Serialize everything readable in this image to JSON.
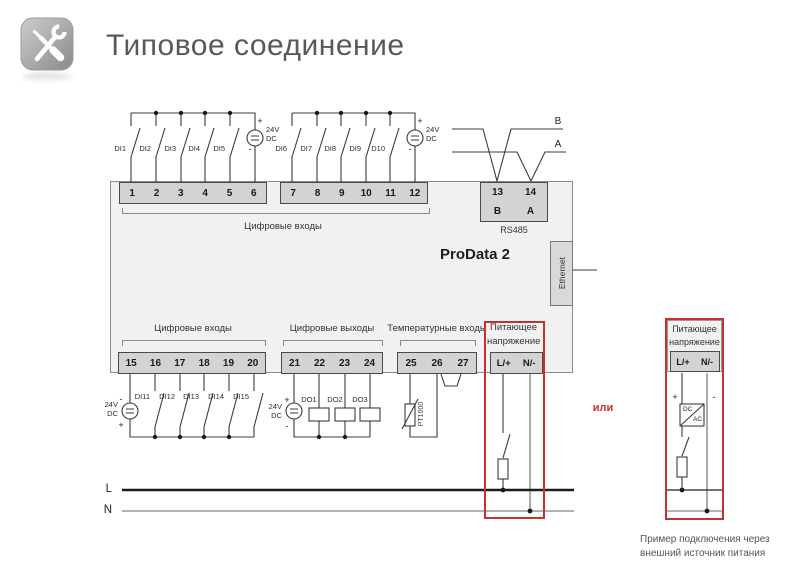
{
  "header": {
    "title": "Типовое соединение"
  },
  "device": {
    "name": "ProData 2",
    "ethernet": "Ethernet",
    "rs485_label": "RS485",
    "top1": [
      "1",
      "2",
      "3",
      "4",
      "5",
      "6"
    ],
    "top2": [
      "7",
      "8",
      "9",
      "10",
      "11",
      "12"
    ],
    "rs485": {
      "n1": "13",
      "n2": "14",
      "b": "B",
      "a": "A"
    },
    "bot1": [
      "15",
      "16",
      "17",
      "18",
      "19",
      "20"
    ],
    "bot2": [
      "21",
      "22",
      "23",
      "24"
    ],
    "bot3": [
      "25",
      "26",
      "27"
    ],
    "pwr": {
      "l": "L/+",
      "n": "N/-"
    }
  },
  "groups": {
    "digital_inputs_top": "Цифровые входы",
    "digital_inputs_bottom": "Цифровые входы",
    "digital_outputs": "Цифровые выходы",
    "temperature_inputs": "Температурные входы",
    "supply1": "Питающее",
    "supply2": "напряжение"
  },
  "signals": {
    "di_top": [
      "DI1",
      "DI2",
      "DI3",
      "DI4",
      "DI5"
    ],
    "di_top2": [
      "DI6",
      "DI7",
      "DI8",
      "DI9",
      "D10"
    ],
    "di_bot": [
      "DI11",
      "DI12",
      "DI13",
      "DI14",
      "DI15"
    ],
    "dout": [
      "DO1",
      "DO2",
      "DO3"
    ],
    "pt": "PT1000",
    "line_b": "B",
    "line_a": "A"
  },
  "source": {
    "v": "24V",
    "t": "DC",
    "plus": "+",
    "minus": "-"
  },
  "rails": {
    "l": "L",
    "n": "N"
  },
  "external": {
    "supply1": "Питающее",
    "supply2": "напряжение",
    "l": "L/+",
    "n": "N/-",
    "dc": "DC",
    "ac": "AC",
    "plus": "+",
    "minus": "-",
    "or": "или",
    "caption1": "Пример подключения через",
    "caption2": "внешний источник питания"
  },
  "colors": {
    "accent_red": "#c53030",
    "device_body": "#f1f1f1",
    "terminal_block": "#d3d3d3"
  }
}
